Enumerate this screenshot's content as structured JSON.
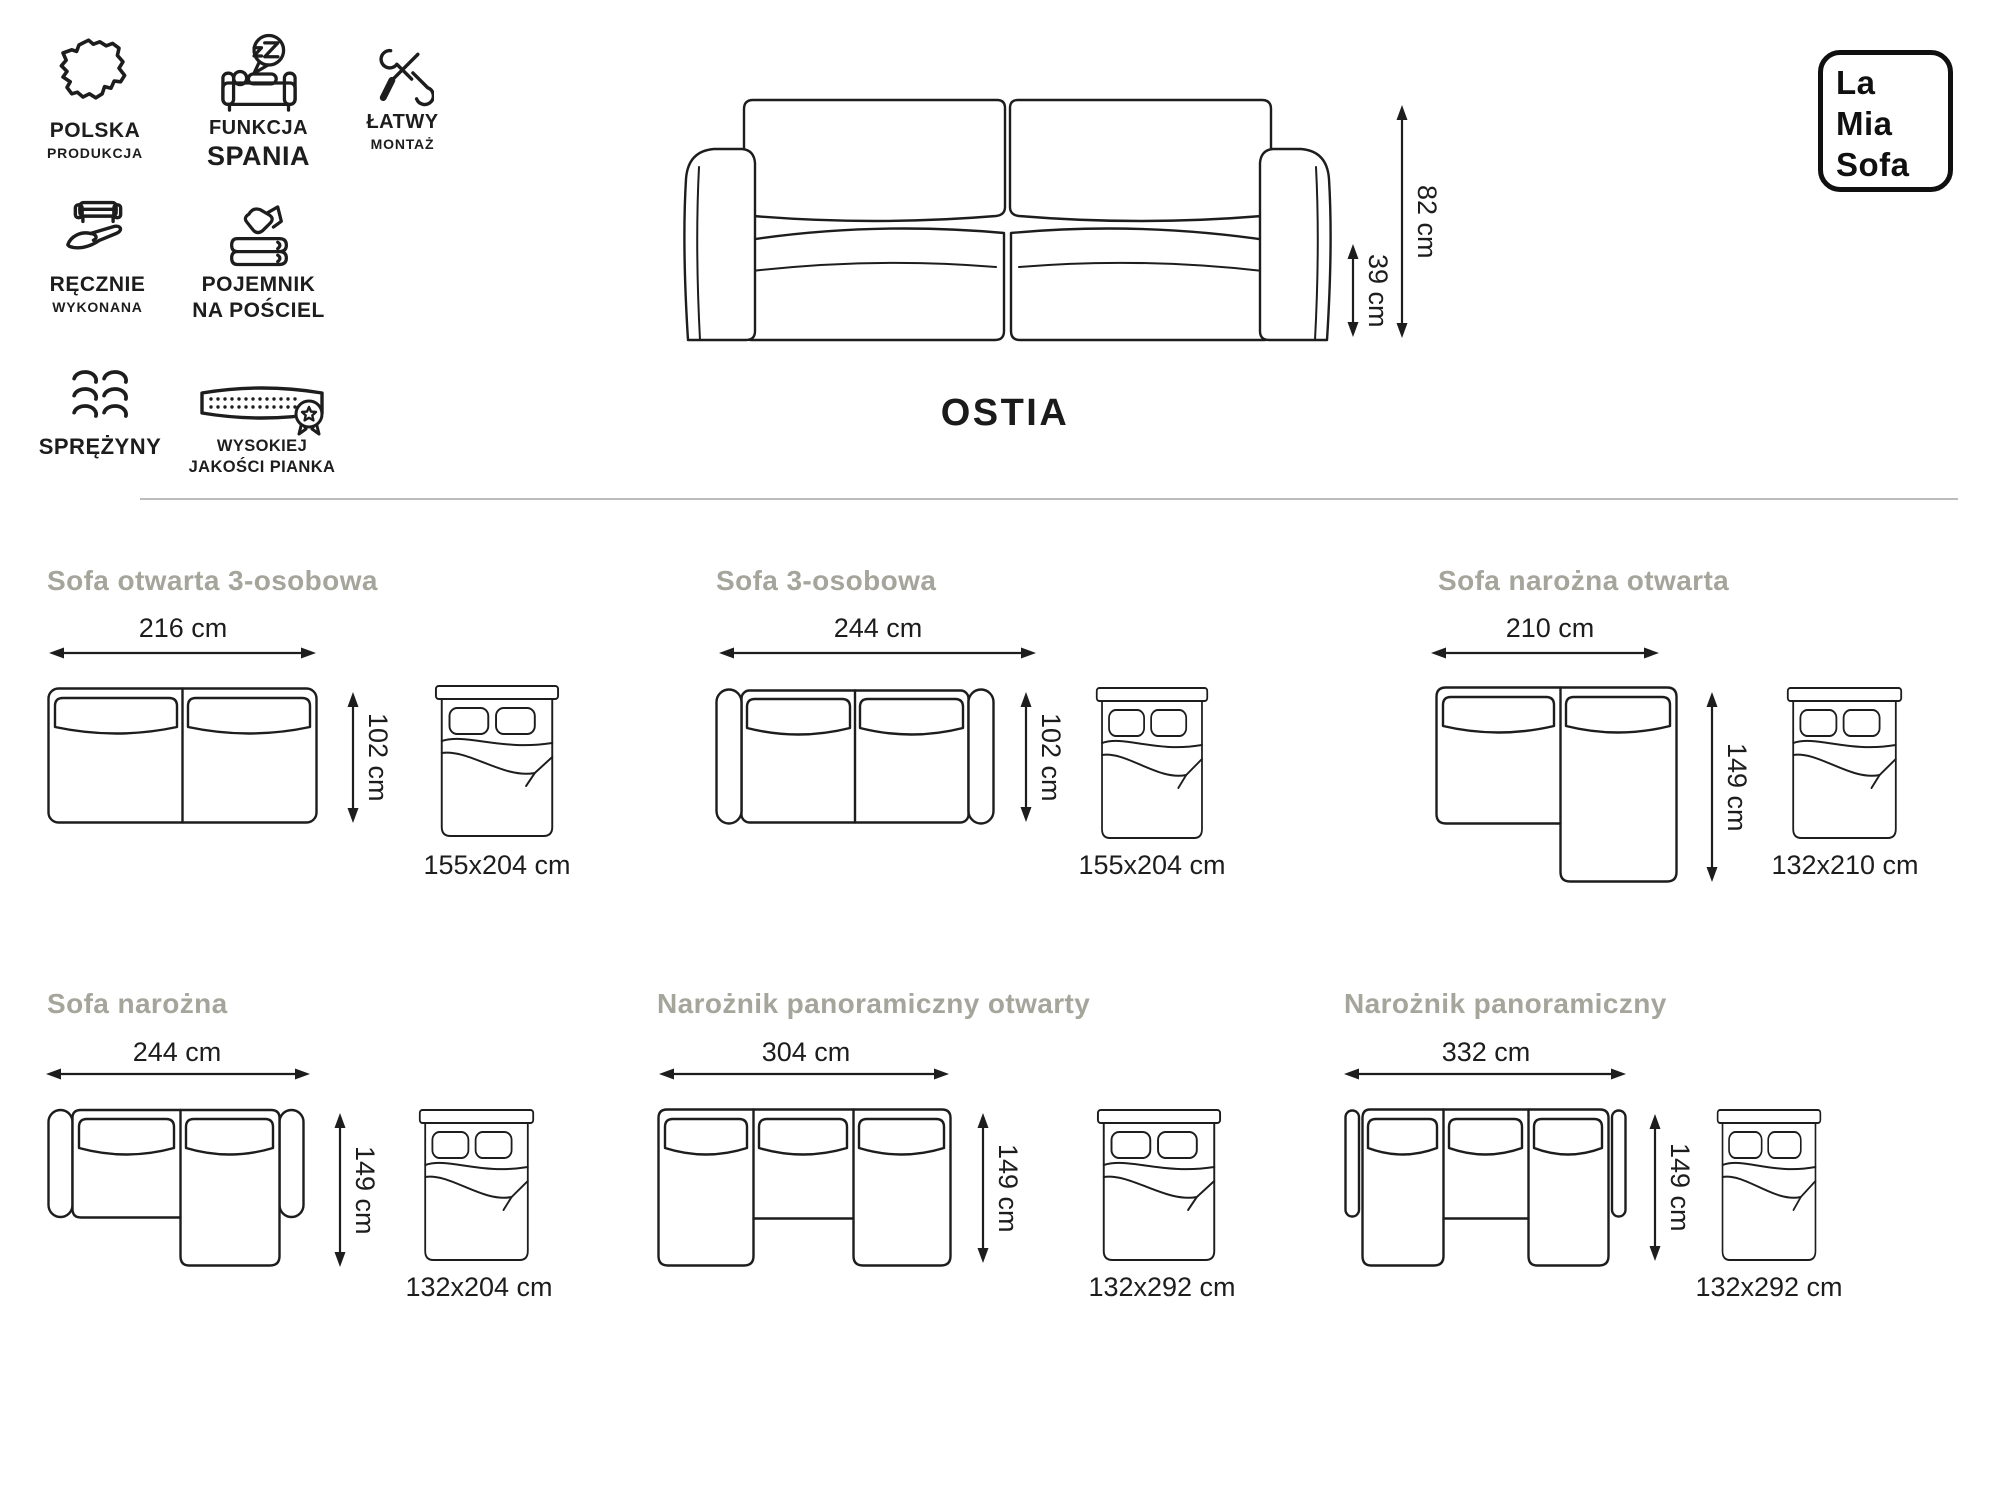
{
  "header": {
    "features": [
      {
        "line1": "POLSKA",
        "line2": "PRODUKCJA"
      },
      {
        "line1": "FUNKCJA",
        "line2": "SPANIA"
      },
      {
        "line1": "ŁATWY",
        "line2": "MONTAŻ"
      },
      {
        "line1": "RĘCZNIE",
        "line2": "WYKONANA"
      },
      {
        "line1": "POJEMNIK",
        "line2": "NA POŚCIEL"
      },
      {
        "line1": "SPRĘŻYNY",
        "line2": ""
      },
      {
        "line1": "WYSOKIEJ",
        "line2": "JAKOŚCI PIANKA"
      }
    ],
    "product_name": "OSTIA",
    "total_height": "82 cm",
    "seat_height": "39 cm",
    "logo": {
      "line1": "La",
      "line2": "Mia",
      "line3": "Sofa"
    }
  },
  "variants": [
    {
      "title": "Sofa otwarta 3-osobowa",
      "width": "216 cm",
      "depth": "102 cm",
      "bed_size": "155x204 cm"
    },
    {
      "title": "Sofa 3-osobowa",
      "width": "244 cm",
      "depth": "102 cm",
      "bed_size": "155x204 cm"
    },
    {
      "title": "Sofa narożna otwarta",
      "width": "210 cm",
      "depth": "149 cm",
      "bed_size": "132x210 cm"
    },
    {
      "title": "Sofa narożna",
      "width": "244 cm",
      "depth": "149 cm",
      "bed_size": "132x204 cm"
    },
    {
      "title": "Narożnik panoramiczny otwarty",
      "width": "304 cm",
      "depth": "149 cm",
      "bed_size": "132x292 cm"
    },
    {
      "title": "Narożnik panoramiczny",
      "width": "332 cm",
      "depth": "149 cm",
      "bed_size": "132x292 cm"
    }
  ],
  "colors": {
    "line_art": "#1d1d1d",
    "title_gray": "#a5a59c",
    "divider": "#bcbcbc"
  }
}
